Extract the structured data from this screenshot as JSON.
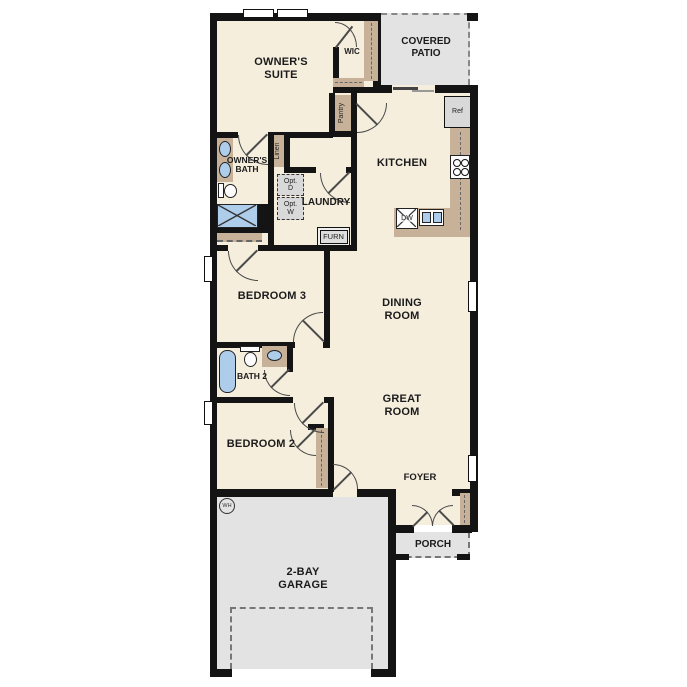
{
  "plan": {
    "rooms": {
      "owners_suite": "OWNER'S SUITE",
      "wic": "WIC",
      "covered_patio": "COVERED PATIO",
      "kitchen": "KITCHEN",
      "owners_bath": "OWNER'S BATH",
      "laundry": "LAUNDRY",
      "bedroom3": "BEDROOM 3",
      "dining_room": "DINING ROOM",
      "bath2": "BATH 2",
      "great_room": "GREAT ROOM",
      "bedroom2": "BEDROOM 2",
      "foyer": "FOYER",
      "porch": "PORCH",
      "garage": "2-BAY GARAGE"
    },
    "closets": {
      "pantry": "Pantry",
      "linen": "Linen"
    },
    "appliances": {
      "ref": "Ref",
      "dw": "DW",
      "furn": "FURN",
      "opt_d": "Opt. D",
      "opt_w": "Opt. W",
      "wh": "WH"
    },
    "colors": {
      "floor": "#f5eedd",
      "wall": "#141414",
      "cabinet_tan": "#c7b299",
      "outdoor_gray": "#e3e3e3",
      "fixture_blue": "#aecdea"
    }
  }
}
